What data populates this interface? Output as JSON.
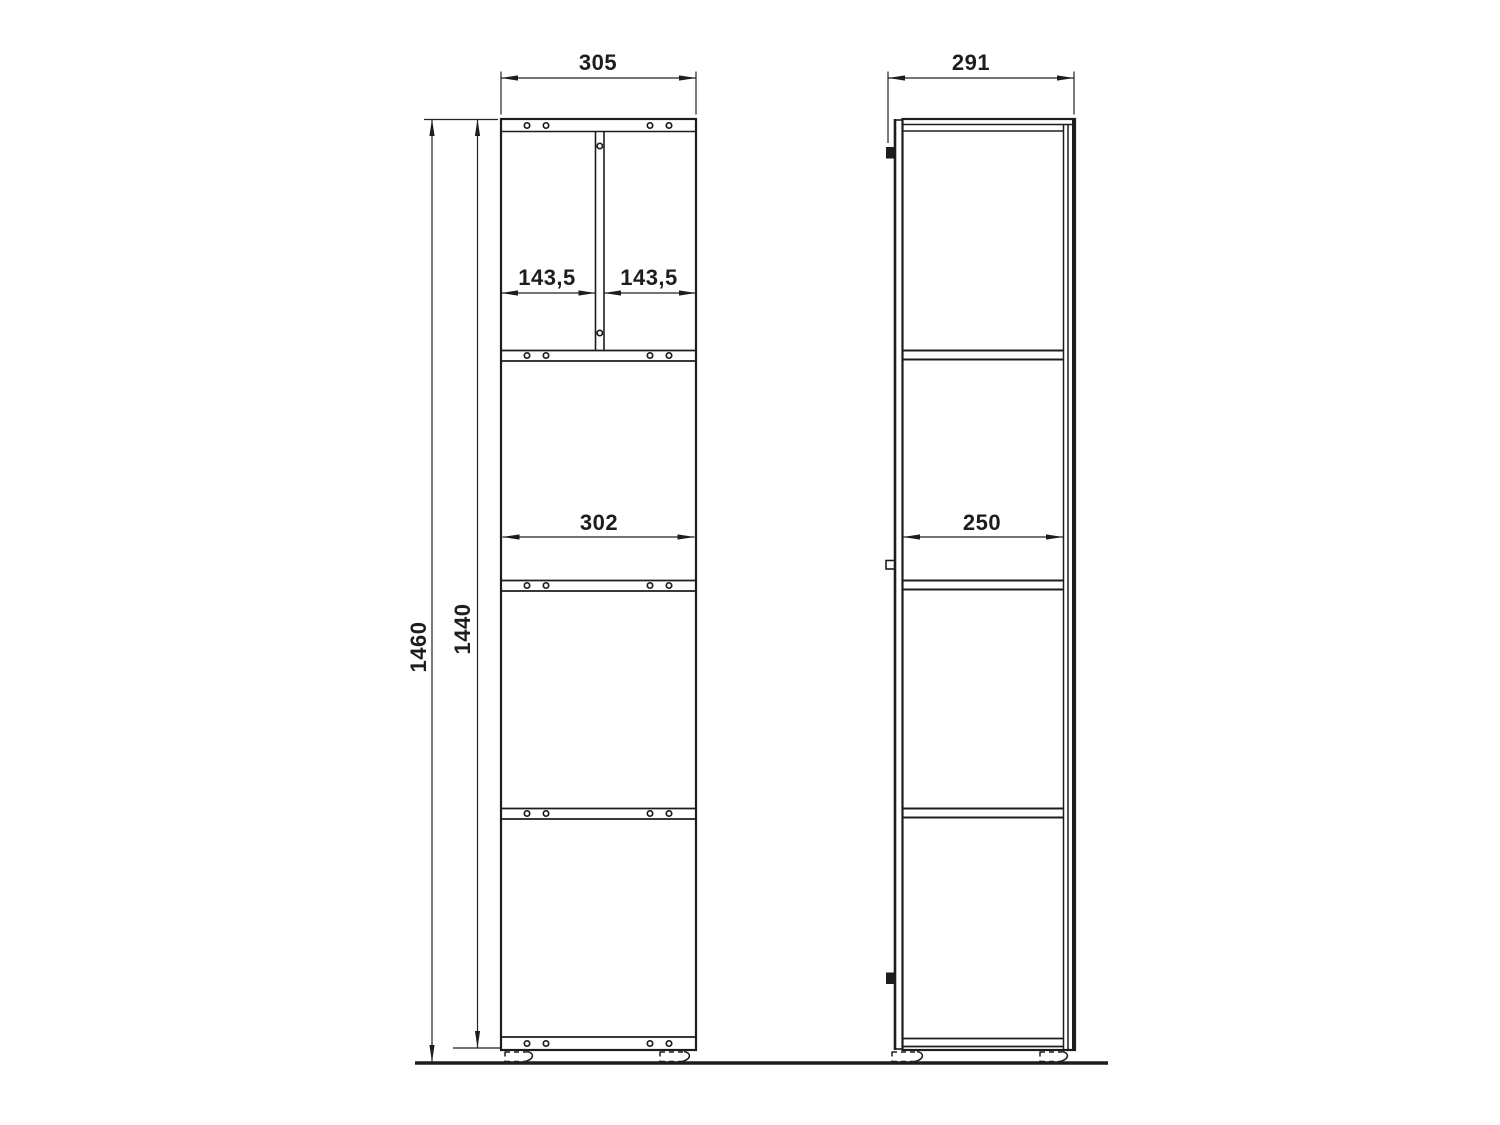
{
  "colors": {
    "line": "#1d1d1b",
    "background": "#ffffff"
  },
  "views": {
    "front": {
      "dims": {
        "overall_width": "305",
        "compartment_left": "143,5",
        "compartment_right": "143,5",
        "inner_width": "302",
        "overall_height": "1460",
        "carcass_height": "1440"
      }
    },
    "side": {
      "dims": {
        "overall_depth": "291",
        "inner_depth": "250"
      }
    }
  }
}
